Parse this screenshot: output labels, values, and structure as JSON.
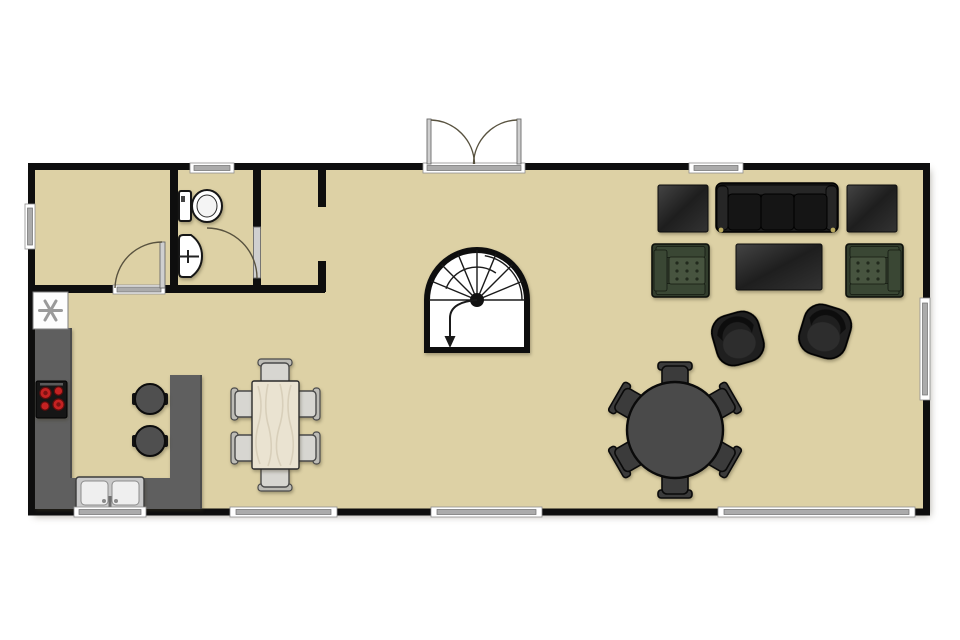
{
  "meta": {
    "title": "Single-storey house floor plan",
    "view": "top-down architectural plan",
    "canvas": {
      "width": 960,
      "height": 640
    }
  },
  "palette": {
    "background": "#FFFFFF",
    "floor": "#DDD1A5",
    "wall": "#0E0E0E",
    "window_frame": "#FFFFFF",
    "window_glass": "#ABABAB",
    "door_arc": "#58523F",
    "counter": "#5F5F5F",
    "stove": "#161616",
    "burner": "#C42222",
    "sink_steel": "#C9C9C9",
    "basin": "#EFEFEF",
    "wood": "#EAE3D1",
    "chair_light": "#D7D6D1",
    "sofa": "#1B1B1B",
    "armchair_frame": "#323D2D",
    "armchair_arm": "#3A4734",
    "armchair_cushion": "#47543F",
    "round_table": "#4A4A4A",
    "seat_dark": "#3B3B3B",
    "stool": "#4F4F4F",
    "swivel": "#1F1F1F"
  },
  "plan": {
    "rooms": [
      "room-top-left",
      "bathroom",
      "hall",
      "open-plan-living-kitchen-dining"
    ],
    "entry": "double-outswing-entry-door-top-center",
    "window_count": 8,
    "interior_doors": [
      "room-top-left-door",
      "bathroom-door"
    ],
    "stairs": "curved-winder-staircase-center, arrow indicates down direction"
  },
  "inventory": {
    "fixtures": [
      {
        "item": "toilet",
        "room": "bathroom"
      },
      {
        "item": "pedestal-sink",
        "room": "bathroom"
      },
      {
        "item": "ceiling-fan-symbol",
        "room": "kitchen"
      },
      {
        "item": "four-burner-cooktop",
        "room": "kitchen"
      },
      {
        "item": "double-basin-sink",
        "room": "kitchen"
      }
    ],
    "furniture": [
      {
        "item": "kitchen-peninsula-counter",
        "seats": 2,
        "seat_type": "bar-stool"
      },
      {
        "item": "rectangular-wood-dining-table",
        "seats": 6
      },
      {
        "item": "round-table",
        "seats": 6
      },
      {
        "item": "three-seat-sofa",
        "count": 1
      },
      {
        "item": "square-side-table",
        "count": 2
      },
      {
        "item": "tufted-green-armchair",
        "count": 2
      },
      {
        "item": "rectangular-coffee-table",
        "count": 1
      },
      {
        "item": "swivel-tub-chair",
        "count": 2
      }
    ]
  }
}
